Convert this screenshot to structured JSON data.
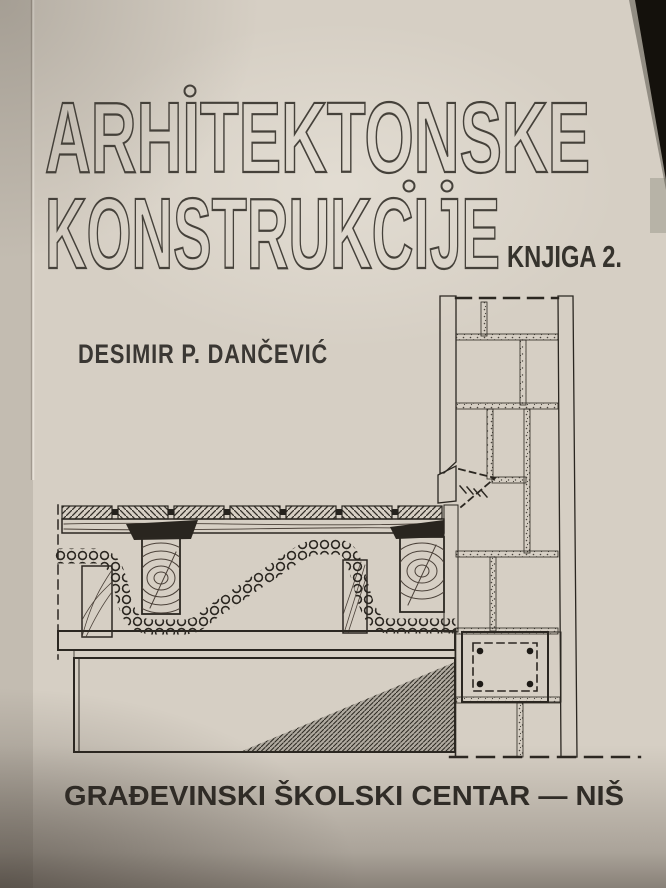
{
  "cover": {
    "title_line1": "ARHITEKTONSKE",
    "title_line2": "KONSTRUKCIJE",
    "edition": "KNJIGA 2.",
    "author": "DESIMIR P. DANČEVIĆ",
    "publisher": "GRAĐEVINSKI ŠKOLSKI CENTAR — NIŠ",
    "illustration_name": "masonry-wall-floor-junction-section-drawing",
    "colors": {
      "paper": "#d6cfc4",
      "ink": "#2b2721",
      "title_outline": "#45413a",
      "corner_shadow": "#14110c"
    }
  }
}
